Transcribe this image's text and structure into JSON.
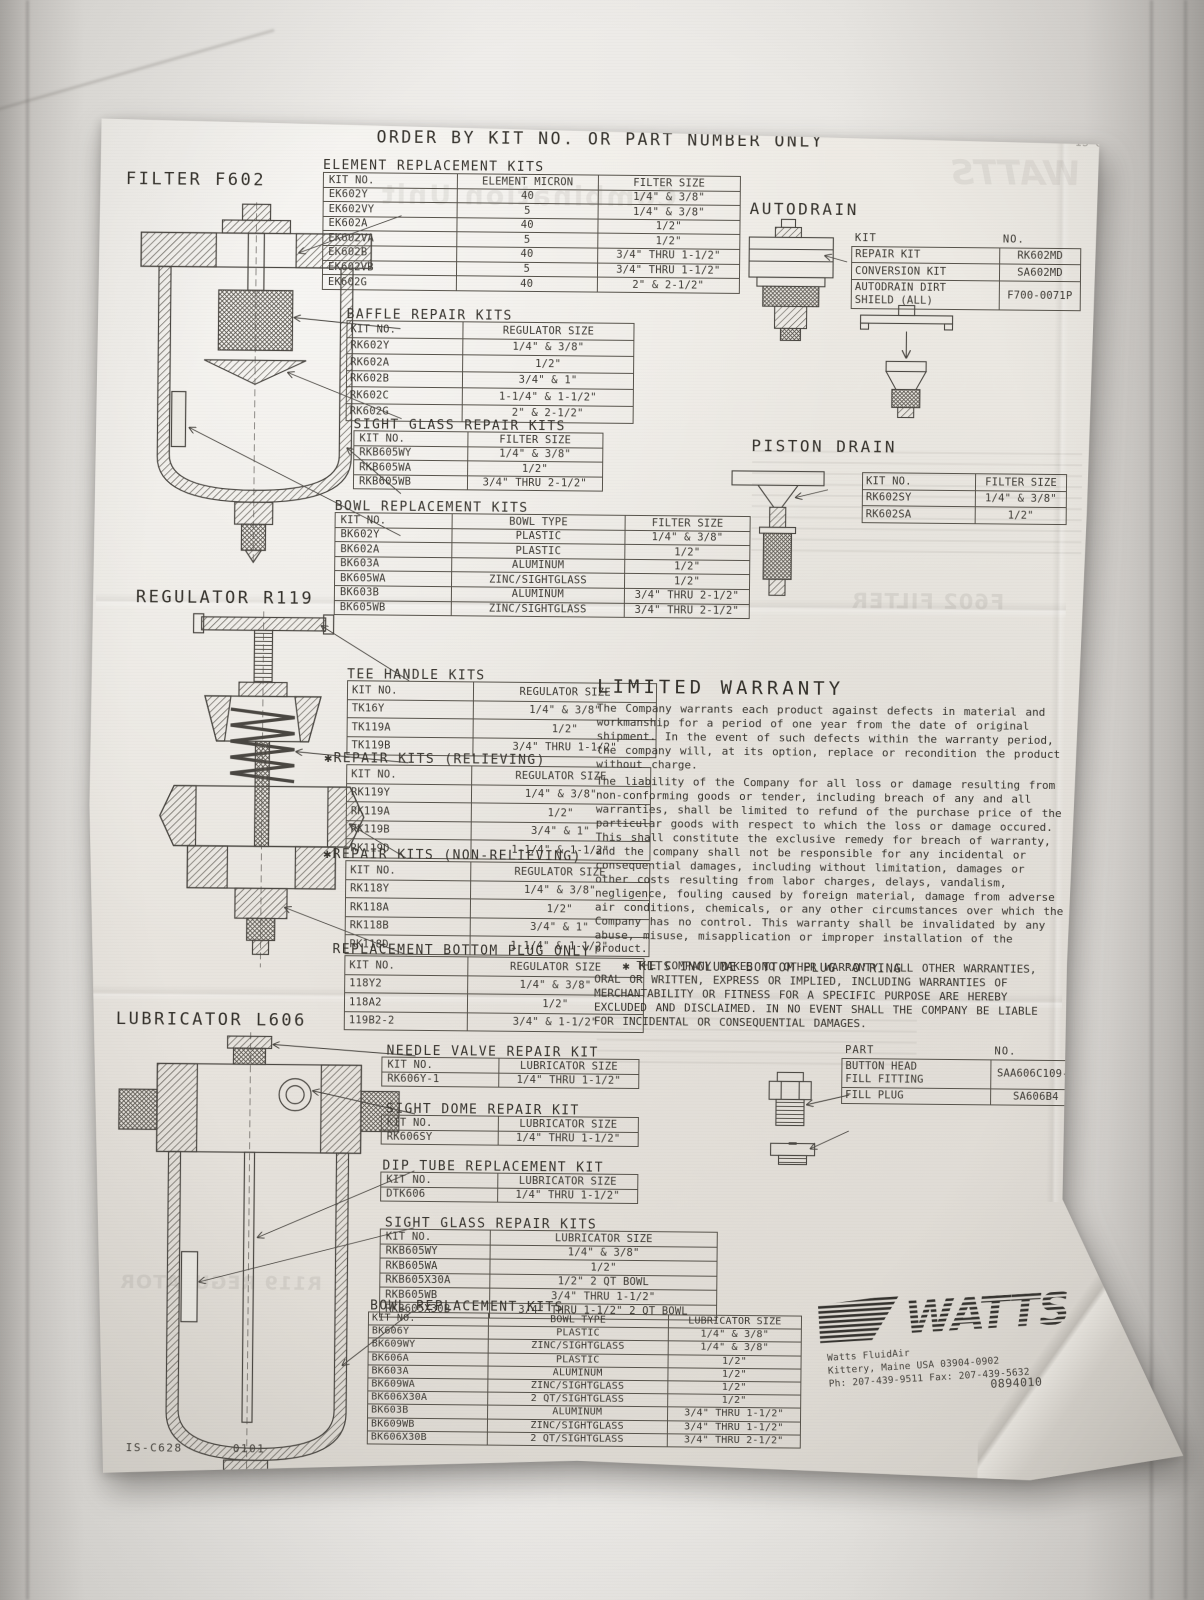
{
  "header": {
    "order_title": "ORDER BY KIT NO. OR PART NUMBER ONLY"
  },
  "filter": {
    "label": "FILTER F602",
    "element_kits": {
      "title": "ELEMENT REPLACEMENT KITS",
      "headers": [
        "KIT NO.",
        "ELEMENT MICRON",
        "FILTER SIZE"
      ],
      "rows": [
        [
          "EK602Y",
          "40",
          "1/4\" & 3/8\""
        ],
        [
          "EK602VY",
          "5",
          "1/4\" & 3/8\""
        ],
        [
          "EK602A",
          "40",
          "1/2\""
        ],
        [
          "EK602VA",
          "5",
          "1/2\""
        ],
        [
          "EK602B",
          "40",
          "3/4\" THRU 1-1/2\""
        ],
        [
          "EK602VB",
          "5",
          "3/4\" THRU 1-1/2\""
        ],
        [
          "EK602G",
          "40",
          "2\" & 2-1/2\""
        ]
      ]
    },
    "baffle_kits": {
      "title": "BAFFLE REPAIR KITS",
      "headers": [
        "KIT NO.",
        "REGULATOR SIZE"
      ],
      "rows": [
        [
          "RK602Y",
          "1/4\" & 3/8\""
        ],
        [
          "RK602A",
          "1/2\""
        ],
        [
          "RK602B",
          "3/4\" & 1\""
        ],
        [
          "RK602C",
          "1-1/4\" & 1-1/2\""
        ],
        [
          "RK602G",
          "2\" & 2-1/2\""
        ]
      ]
    },
    "sight_glass_kits": {
      "title": "SIGHT GLASS REPAIR KITS",
      "headers": [
        "KIT NO.",
        "FILTER SIZE"
      ],
      "rows": [
        [
          "RKB605WY",
          "1/4\" & 3/8\""
        ],
        [
          "RKB605WA",
          "1/2\""
        ],
        [
          "RKB605WB",
          "3/4\" THRU 2-1/2\""
        ]
      ]
    },
    "bowl_kits": {
      "title": "BOWL REPLACEMENT KITS",
      "headers": [
        "KIT NO.",
        "BOWL TYPE",
        "FILTER SIZE"
      ],
      "rows": [
        [
          "BK602Y",
          "PLASTIC",
          "1/4\" & 3/8\""
        ],
        [
          "BK602A",
          "PLASTIC",
          "1/2\""
        ],
        [
          "BK603A",
          "ALUMINUM",
          "1/2\""
        ],
        [
          "BK605WA",
          "ZINC/SIGHTGLASS",
          "1/2\""
        ],
        [
          "BK603B",
          "ALUMINUM",
          "3/4\" THRU 2-1/2\""
        ],
        [
          "BK605WB",
          "ZINC/SIGHTGLASS",
          "3/4\" THRU 2-1/2\""
        ]
      ]
    }
  },
  "autodrain": {
    "label": "AUTODRAIN",
    "kit_table": {
      "headers": [
        "KIT",
        "NO."
      ],
      "header_outside": true,
      "rows": [
        [
          "REPAIR KIT",
          "RK602MD"
        ],
        [
          "CONVERSION KIT",
          "SA602MD"
        ],
        [
          "AUTODRAIN DIRT\nSHIELD  (ALL)",
          "F700-0071P"
        ]
      ]
    }
  },
  "piston_drain": {
    "label": "PISTON DRAIN",
    "kit_table": {
      "headers": [
        "KIT  NO.",
        "FILTER SIZE"
      ],
      "rows": [
        [
          "RK602SY",
          "1/4\" & 3/8\""
        ],
        [
          "RK602SA",
          "1/2\""
        ]
      ]
    }
  },
  "regulator": {
    "label": "REGULATOR R119",
    "tee_handle_kits": {
      "title": "TEE HANDLE KITS",
      "headers": [
        "KIT NO.",
        "REGULATOR SIZE"
      ],
      "rows": [
        [
          "TK16Y",
          "1/4\" & 3/8\""
        ],
        [
          "TK119A",
          "1/2\""
        ],
        [
          "TK119B",
          "3/4\" THRU 1-1/2\""
        ]
      ]
    },
    "repair_kits_relieving": {
      "title": "✱REPAIR KITS (RELIEVING)",
      "headers": [
        "KIT NO.",
        "REGULATOR SIZE"
      ],
      "rows": [
        [
          "RK119Y",
          "1/4\" & 3/8\""
        ],
        [
          "RK119A",
          "1/2\""
        ],
        [
          "RK119B",
          "3/4\" & 1\""
        ],
        [
          "RK119D",
          "1-1/4\" & 1-1/2\""
        ]
      ]
    },
    "repair_kits_non_relieving": {
      "title": "✱REPAIR KITS (NON-RELIEVING)",
      "headers": [
        "KIT NO.",
        "REGULATOR SIZE"
      ],
      "rows": [
        [
          "RK118Y",
          "1/4\" & 3/8\""
        ],
        [
          "RK118A",
          "1/2\""
        ],
        [
          "RK118B",
          "3/4\" & 1\""
        ],
        [
          "RK118D",
          "1-1/4\" & 1-1/2\""
        ]
      ]
    },
    "bottom_plug": {
      "title": "REPLACEMENT BOTTOM PLUG ONLY",
      "headers": [
        "KIT NO.",
        "REGULATOR SIZE"
      ],
      "rows": [
        [
          "118Y2",
          "1/4\" & 3/8\""
        ],
        [
          "118A2",
          "1/2\""
        ],
        [
          "119B2-2",
          "3/4\" & 1-1/2\""
        ]
      ]
    }
  },
  "warranty": {
    "title": "LIMITED WARRANTY",
    "p1": "The Company warrants each product against defects in material and workmanship for a period of one year from the date of original shipment.  In the event of such defects within the warranty period, the company will, at its option, replace or recondition the product without charge.",
    "p2": "The liability of the Company for all loss or damage resulting from non-conforming goods or tender, including breach of any and all warranties, shall be limited to refund of the purchase price of the particular goods with respect to which the loss or damage occured. This shall constitute the exclusive remedy for breach of warranty, and the company shall not be responsible for any incidental or consequential damages, including without limitation, damages or other costs resulting from labor charges, delays, vandalism, negligence, fouling caused by foreign material, damage from adverse air conditions, chemicals, or any other circumstances over which the Company has no control. This warranty shall be invalidated by any abuse, misuse, misapplication or improper installation of the product.",
    "p3": "THE COMPANY MAKES NO OTHER WARRANTY. ALL OTHER WARRANTIES, ORAL OR WRITTEN, EXPRESS OR IMPLIED, INCLUDING WARRANTIES OF MERCHANTABILITY OR FITNESS FOR A SPECIFIC PURPOSE ARE HEREBY EXCLUDED AND DISCLAIMED. IN NO EVENT SHALL THE COMPANY BE LIABLE FOR INCIDENTAL OR CONSEQUENTIAL DAMAGES.",
    "note": "✱ KITS INCLUDE BOTTOM PLUG 'O'RING"
  },
  "lubricator": {
    "label": "LUBRICATOR L606",
    "needle_valve_kit": {
      "title": "NEEDLE VALVE REPAIR KIT",
      "headers": [
        "KIT NO.",
        "LUBRICATOR SIZE"
      ],
      "rows": [
        [
          "RK606Y-1",
          "1/4\" THRU 1-1/2\""
        ]
      ]
    },
    "sight_dome_kit": {
      "title": "SIGHT DOME REPAIR KIT",
      "headers": [
        "KIT NO.",
        "LUBRICATOR SIZE"
      ],
      "rows": [
        [
          "RK606SY",
          "1/4\" THRU 1-1/2\""
        ]
      ]
    },
    "dip_tube_kit": {
      "title": "DIP TUBE REPLACEMENT KIT",
      "headers": [
        "KIT NO.",
        "LUBRICATOR SIZE"
      ],
      "rows": [
        [
          "DTK606",
          "1/4\" THRU 1-1/2\""
        ]
      ]
    },
    "sight_glass_kits": {
      "title": "SIGHT GLASS REPAIR KITS",
      "headers": [
        "KIT NO.",
        "LUBRICATOR SIZE"
      ],
      "rows": [
        [
          "RKB605WY",
          "1/4\" & 3/8\""
        ],
        [
          "RKB605WA",
          "1/2\""
        ],
        [
          "RKB605X30A",
          "1/2\" 2 QT BOWL"
        ],
        [
          "RKB605WB",
          "3/4\" THRU 1-1/2\""
        ],
        [
          "RKB605X30B",
          "3/4\" THRU 1-1/2\" 2 QT BOWL"
        ]
      ]
    },
    "bowl_kits": {
      "title": "BOWL REPLACEMENT KITS",
      "headers": [
        "KIT NO.",
        "BOWL TYPE",
        "LUBRICATOR SIZE"
      ],
      "rows": [
        [
          "BK606Y",
          "PLASTIC",
          "1/4\" & 3/8\""
        ],
        [
          "BK609WY",
          "ZINC/SIGHTGLASS",
          "1/4\" & 3/8\""
        ],
        [
          "BK606A",
          "PLASTIC",
          "1/2\""
        ],
        [
          "BK603A",
          "ALUMINUM",
          "1/2\""
        ],
        [
          "BK609WA",
          "ZINC/SIGHTGLASS",
          "1/2\""
        ],
        [
          "BK606X30A",
          "2 QT/SIGHTGLASS",
          "1/2\""
        ],
        [
          "BK603B",
          "ALUMINUM",
          "3/4\" THRU 1-1/2\""
        ],
        [
          "BK609WB",
          "ZINC/SIGHTGLASS",
          "3/4\" THRU 1-1/2\""
        ],
        [
          "BK606X30B",
          "2 QT/SIGHTGLASS",
          "3/4\" THRU 2-1/2\""
        ]
      ]
    },
    "fill_parts": {
      "headers": [
        "PART",
        "NO."
      ],
      "header_outside": true,
      "rows": [
        [
          "BUTTON HEAD\nFILL FITTING",
          "SAA606C109-1"
        ],
        [
          "FILL PLUG",
          "SA606B4"
        ]
      ]
    }
  },
  "watts": {
    "logo_text": "WATTS",
    "company": "Watts FluidAir",
    "address": "Kittery, Maine USA 03904-0902",
    "phone": "Ph: 207-439-9511 Fax: 207-439-5632"
  },
  "footer": {
    "form_number": "IS-C628",
    "revision": "0101",
    "doc_number": "0894010"
  },
  "bleedthrough": {
    "heading": "Combination Unit",
    "logo": "WATTS",
    "filter": "F602 FILTER",
    "regulator": "R119 REGULATOR",
    "corner": "IS-C628"
  }
}
